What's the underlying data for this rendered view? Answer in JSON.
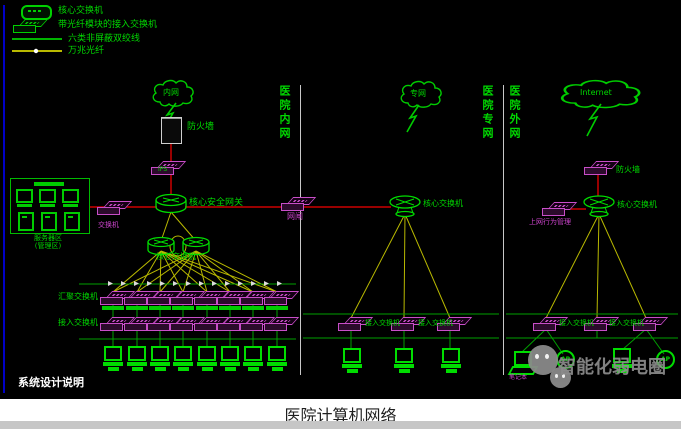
{
  "legend": {
    "core_switch": "核心交换机",
    "access_switch_fiber": "带光纤模块的接入交换机",
    "cat6": "六类非屏蔽双绞线",
    "fiber_10g": "万兆光纤"
  },
  "zones": {
    "intranet": "医院内网",
    "private": "医院专网",
    "external": "医院外网"
  },
  "clouds": {
    "intranet": "内网",
    "private": "专网",
    "internet": "Internet"
  },
  "intranet": {
    "firewall": "防火墙",
    "ips": "IPS",
    "core_gateway": "核心安全网关",
    "core_switch": "核心交换机",
    "gatekeeper": "网闸",
    "aggregation_switch": "汇聚交换机",
    "access_switch": "接入交换机",
    "server_zone_line1": "服务器区",
    "server_zone_line2": "(管理区)",
    "server_switch": "交换机"
  },
  "private_net": {
    "core_switch": "核心交换机",
    "access_switch_1": "接入交换机",
    "access_switch_2": "接入交换机"
  },
  "external_net": {
    "firewall": "防火墙",
    "behavior_mgmt": "上网行为管理",
    "core_switch": "核心交换机",
    "access_switch_1": "接入交换机",
    "access_switch_2": "接入交换机",
    "laptop": "笔记本",
    "ap1": "AP",
    "ap2": "AP"
  },
  "notes": {
    "design_note": "系统设计说明"
  },
  "watermark": {
    "text": "智能化弱电圈"
  },
  "caption": "医院计算机网络",
  "colors": {
    "background": "#000000",
    "device_green": "#00dd00",
    "switch_magenta": "#c84ec8",
    "link_red": "#cc0000",
    "fiber_yellow": "#b9b900",
    "divider_white": "#c8c8c8",
    "frame_blue": "#0000c8",
    "watermark_gray": "#8c8c8c"
  }
}
